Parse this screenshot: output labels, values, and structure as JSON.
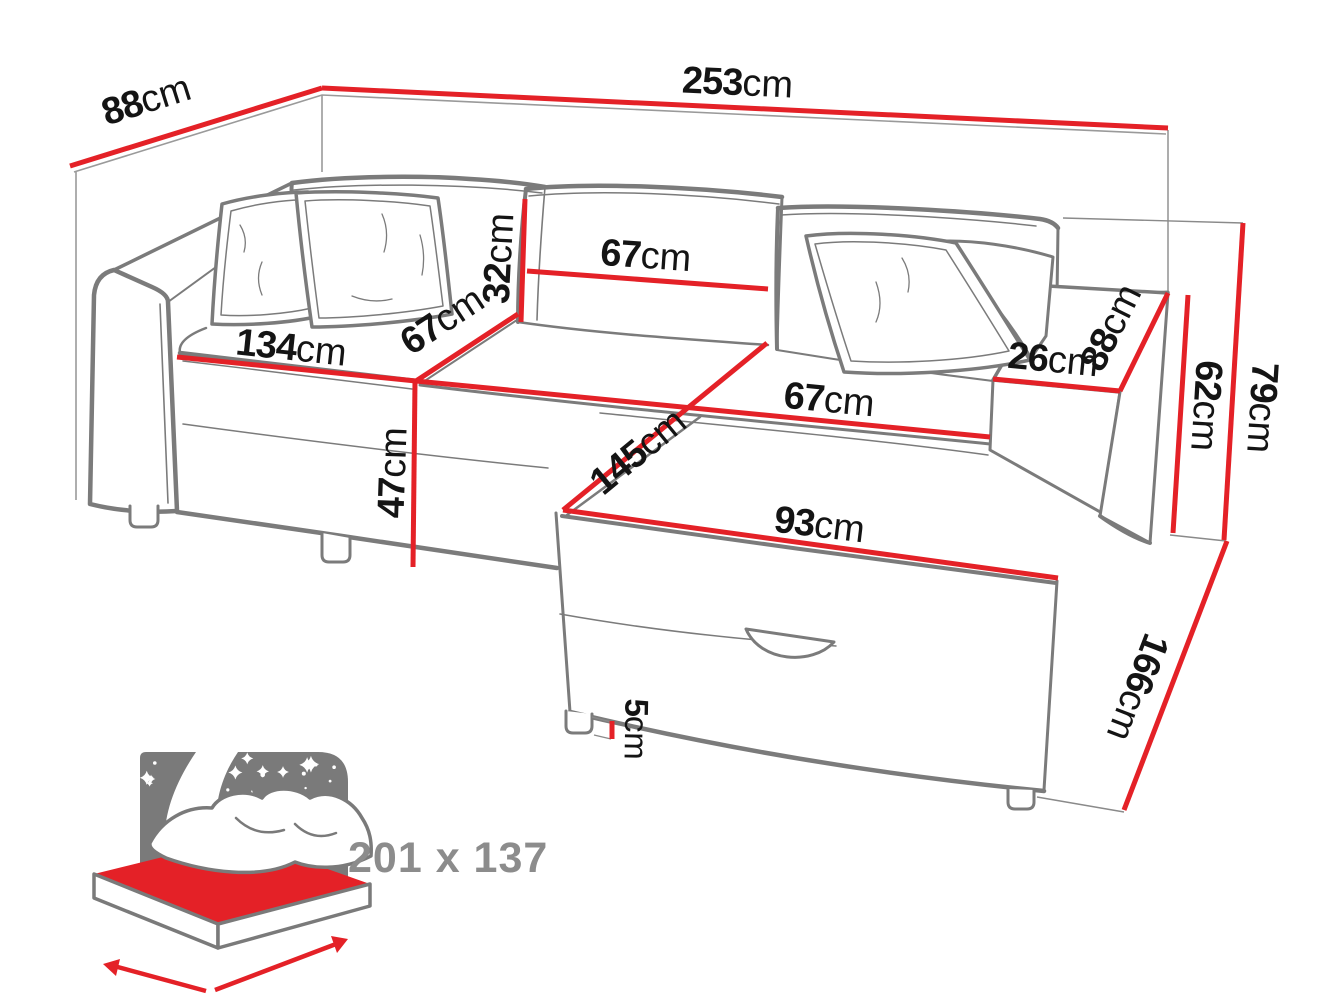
{
  "diagram": {
    "kind": "furniture-dimension-diagram",
    "subject": "corner sofa bed with chaise and storage",
    "unit": "cm",
    "colors": {
      "dimension_red": "#e42127",
      "line_art_gray": "#7b7b7b",
      "thin_line_gray": "#9a9a9a",
      "label_black": "#141414",
      "muted_gray": "#8c8c8c",
      "background": "#ffffff"
    },
    "dimensions": {
      "wall_depth_left": {
        "label": "88cm",
        "value": 88,
        "meaning": "depth along left wall"
      },
      "wall_width": {
        "label": "253cm",
        "value": 253,
        "meaning": "total width along back wall"
      },
      "backrest_height": {
        "label": "32cm",
        "value": 32,
        "meaning": "back cushion height"
      },
      "back_cushion_width": {
        "label": "67cm",
        "value": 67,
        "meaning": "back cushion width"
      },
      "seat_width_left": {
        "label": "134cm",
        "value": 134,
        "meaning": "left seat width"
      },
      "seat_depth": {
        "label": "67cm",
        "value": 67,
        "meaning": "seat depth"
      },
      "seat_height": {
        "label": "47cm",
        "value": 47,
        "meaning": "seat height"
      },
      "chaise_seat_width": {
        "label": "67cm",
        "value": 67,
        "meaning": "corner seat width"
      },
      "chaise_length": {
        "label": "145cm",
        "value": 145,
        "meaning": "chaise length"
      },
      "chaise_front_width": {
        "label": "93cm",
        "value": 93,
        "meaning": "chaise front width"
      },
      "armrest_width": {
        "label": "26cm",
        "value": 26,
        "meaning": "armrest width"
      },
      "armrest_length": {
        "label": "88cm",
        "value": 88,
        "meaning": "armrest length"
      },
      "arm_height": {
        "label": "62cm",
        "value": 62,
        "meaning": "armrest height"
      },
      "total_height": {
        "label": "79cm",
        "value": 79,
        "meaning": "total height"
      },
      "total_depth_right": {
        "label": "166cm",
        "value": 166,
        "meaning": "total depth of chaise side"
      },
      "leg_height": {
        "label": "5cm",
        "value": 5,
        "meaning": "leg height"
      }
    },
    "sleeping_area": {
      "label": "201 x 137",
      "length": 201,
      "width": 137
    },
    "icons": {
      "sleeping_function": "starry-night-bed-icon"
    }
  }
}
